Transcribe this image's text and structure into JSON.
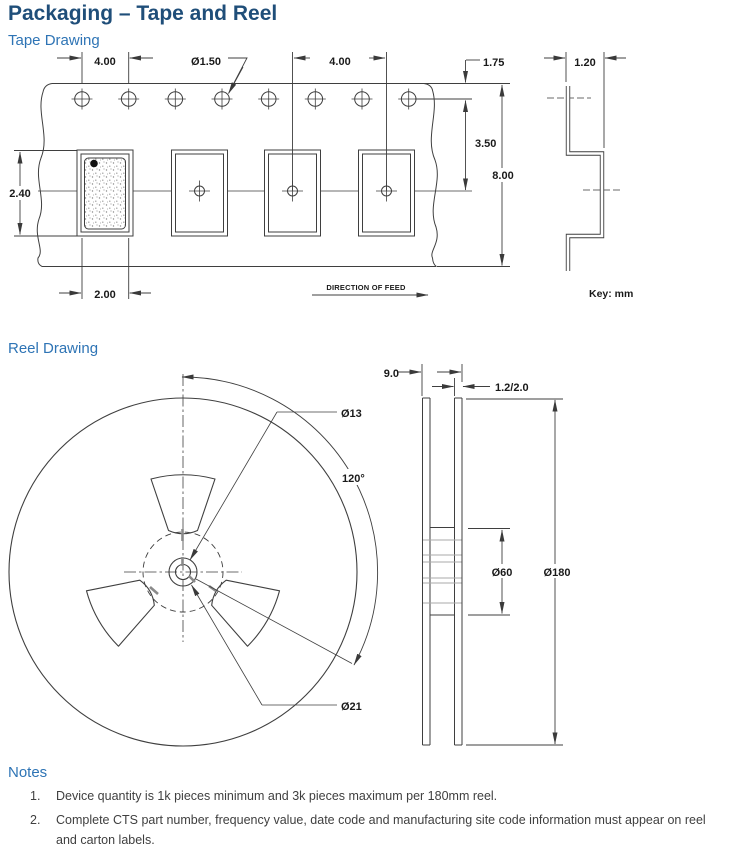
{
  "page": {
    "title": "Packaging – Tape and Reel"
  },
  "tape": {
    "heading": "Tape Drawing",
    "dims": {
      "hole_pitch": "4.00",
      "hole_dia": "Ø1.50",
      "pocket_pitch": "4.00",
      "edge_to_hole": "1.75",
      "hole_to_pocket": "3.50",
      "tape_width": "8.00",
      "pocket_height": "2.40",
      "pocket_width": "2.00",
      "tape_thickness": "1.20"
    },
    "feed_label": "DIRECTION OF FEED",
    "key_label": "Key: mm"
  },
  "reel": {
    "heading": "Reel Drawing",
    "dims": {
      "hub_width": "9.0",
      "flange_thickness": "1.2/2.0",
      "center_hole_dia": "Ø13",
      "window_angle": "120°",
      "hub_dia": "Ø21",
      "inner_dia": "Ø60",
      "outer_dia": "Ø180"
    }
  },
  "notes": {
    "heading": "Notes",
    "items": [
      {
        "num": "1.",
        "text": "Device quantity is 1k pieces minimum and 3k pieces maximum per 180mm reel."
      },
      {
        "num": "2.",
        "text": "Complete CTS part number, frequency value, date code and manufacturing site code information must appear on reel and carton labels."
      }
    ]
  },
  "colors": {
    "heading1": "#1f4e79",
    "heading2": "#2e74b5",
    "line": "#3f3f3f"
  }
}
